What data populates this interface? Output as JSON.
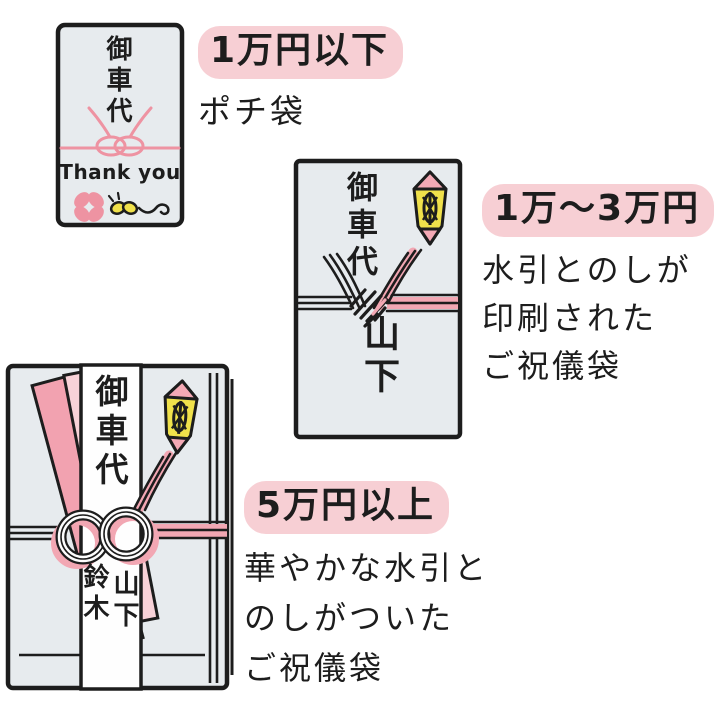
{
  "page": {
    "background": "#ffffff",
    "title": "御車代のご祝儀袋の使い分け"
  },
  "colors": {
    "ink": "#1d1d1d",
    "envelope_fill": "#e7ebee",
    "highlight_pink": "#f7cfd4",
    "ribbon_pink": "#f2a2b0",
    "ribbon_light_pink": "#f8d2d8",
    "cord_pink": "#ee93a2",
    "mizuhiki_pink": "#f2a7b3",
    "noshi_pink": "#f4a9b5",
    "accent_yellow": "#f0e14b",
    "paper_white": "#fefefe"
  },
  "items": [
    {
      "heading": "1万円以下",
      "description_lines": [
        "ポチ袋"
      ],
      "envelope": {
        "front_text": "御車代",
        "message": "Thank you",
        "icons": [
          "pink-mizuhiki-knot",
          "clover-flower",
          "bee-doodle"
        ]
      }
    },
    {
      "heading": "1万〜3万円",
      "description_lines": [
        "水引とのしが",
        "印刷された",
        "ご祝儀袋"
      ],
      "envelope": {
        "front_text": "御車代",
        "giver_names": [
          "山下"
        ],
        "icons": [
          "noshi",
          "printed-mizuhiki"
        ]
      }
    },
    {
      "heading": "5万円以上",
      "description_lines": [
        "華やかな水引と",
        "のしがついた",
        "ご祝儀袋"
      ],
      "envelope": {
        "front_text": "御車代",
        "giver_names": [
          "山下",
          "鈴木"
        ],
        "icons": [
          "noshi",
          "awaji-mizuhiki-knot",
          "pink-ribbon"
        ]
      }
    }
  ]
}
